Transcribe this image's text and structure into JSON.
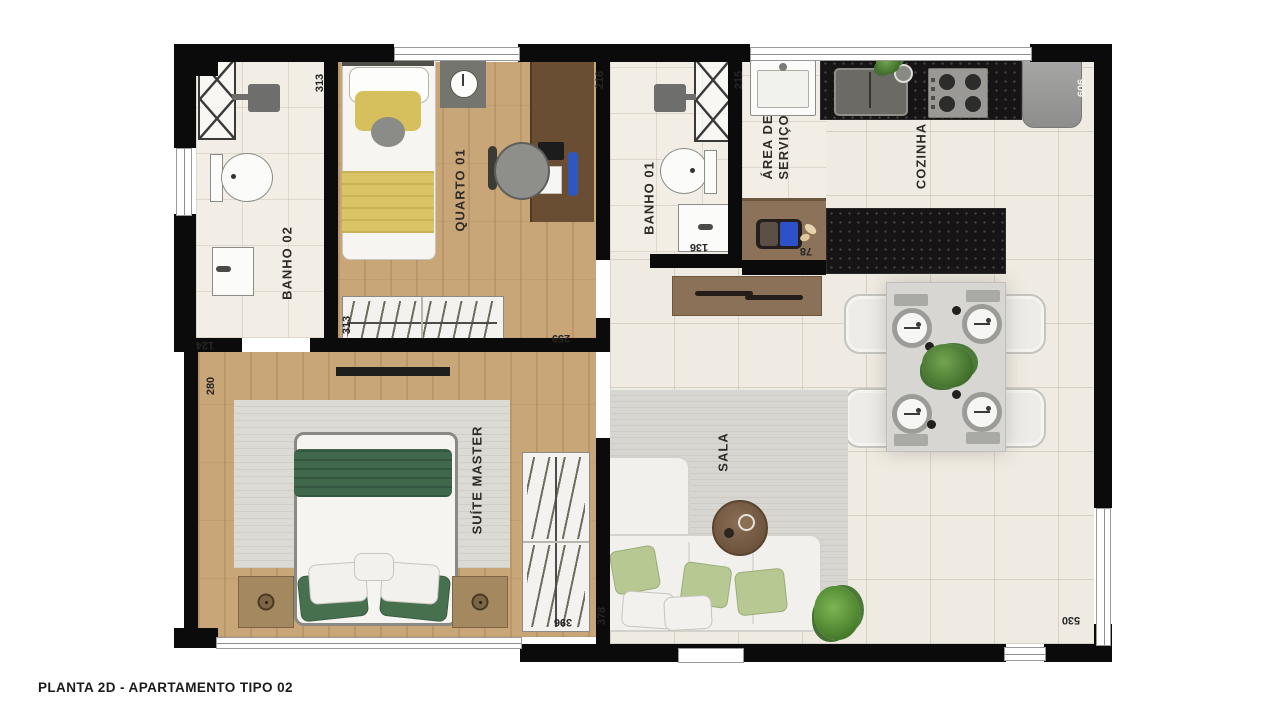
{
  "title": "PLANTA 2D - APARTAMENTO TIPO 02",
  "rooms": {
    "banho02": "BANHO 02",
    "quarto01": "QUARTO 01",
    "banho01": "BANHO 01",
    "area_servico_line1": "ÁREA DE",
    "area_servico_line2": "SERVIÇO",
    "cozinha": "COZINHA",
    "suite_master": "SUÍTE MASTER",
    "sala": "SALA"
  },
  "dimensions": {
    "banho02_top": "313",
    "banho01_top": "216",
    "area_servico_top": "215",
    "cozinha_right": "606",
    "banho02_left_step": "124",
    "suite_left": "280",
    "quarto_bottom_left": "313",
    "quarto_bottom_right": "259",
    "banho01_bottom": "136",
    "desk_nook": "78",
    "suite_wardrobe_bottom": "396",
    "sala_left_bottom": "378",
    "living_bottom_right": "530"
  },
  "colors": {
    "wall": "#0b0b0b",
    "wood_floor": "#c8a678",
    "tile_floor": "#efebe2",
    "granite": "#161414",
    "bed_green": "#41684e",
    "bed_yellow": "#d9c365",
    "sofa_white": "#f1f0ec",
    "plant_green": "#4c7c3c"
  }
}
